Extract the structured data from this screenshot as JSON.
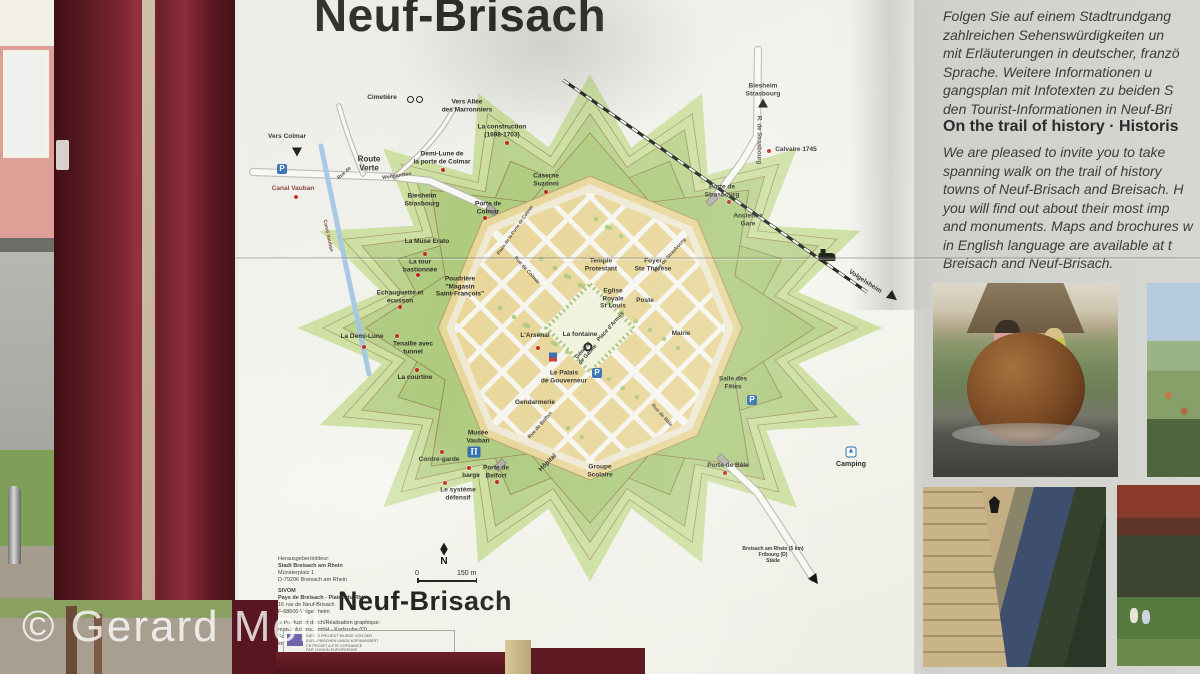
{
  "photo": {
    "watermark": "© Gerard Moll"
  },
  "sign": {
    "title": "Neuf-Brisach",
    "map": {
      "title": "Neuf-Brisach",
      "compass_glyph": "◆",
      "scale": {
        "zero": "0",
        "label": "150 m",
        "north": "N"
      },
      "glyphs": {
        "parking": "P",
        "museum": "Π",
        "camping": "▲"
      },
      "labels": [
        {
          "t": "Cimetière",
          "x": 137,
          "y": 58
        },
        {
          "t": "Vers Allée\ndes Marronniers",
          "x": 222,
          "y": 66
        },
        {
          "t": "Vers Colmar",
          "x": 42,
          "y": 97,
          "c": "b"
        },
        {
          "t": "Route\nVerte",
          "x": 124,
          "y": 124,
          "c": "b",
          "s": 8
        },
        {
          "t": "Rue de",
          "x": 100,
          "y": 134,
          "r": -42,
          "c": "street"
        },
        {
          "t": "Wolfgantzen",
          "x": 152,
          "y": 137,
          "r": -8,
          "c": "street"
        },
        {
          "t": "Demi-Lune de\nla porte de Colmar",
          "x": 197,
          "y": 118
        },
        {
          "t": "Canal Vauban",
          "x": 48,
          "y": 149,
          "c": "maroon"
        },
        {
          "t": "Canal Vauban",
          "x": 82,
          "y": 196,
          "r": 78,
          "c": "street maroon"
        },
        {
          "t": "Biesheim\nStrasbourg",
          "x": 177,
          "y": 160
        },
        {
          "t": "La construction\n(1698-1703)",
          "x": 257,
          "y": 91
        },
        {
          "t": "Caserne\nSuzonni",
          "x": 301,
          "y": 140
        },
        {
          "t": "Porte de\nColmar",
          "x": 243,
          "y": 168
        },
        {
          "t": "Place de la Porte de Colmar",
          "x": 270,
          "y": 190,
          "r": -55,
          "c": "street",
          "s": 4.5
        },
        {
          "t": "La Muse Erato",
          "x": 182,
          "y": 202
        },
        {
          "t": "La tour\nbastionnée",
          "x": 175,
          "y": 226
        },
        {
          "t": "Poudrière\n\"Magasin\nSaint-François\"",
          "x": 215,
          "y": 247
        },
        {
          "t": "Echauguette et\nécusson",
          "x": 155,
          "y": 257
        },
        {
          "t": "La Demi-Lune",
          "x": 117,
          "y": 297
        },
        {
          "t": "Tenaille avec\ntunnel",
          "x": 168,
          "y": 308
        },
        {
          "t": "La courtine",
          "x": 170,
          "y": 338
        },
        {
          "t": "L'Arsenal",
          "x": 290,
          "y": 296
        },
        {
          "t": "La fontaine",
          "x": 335,
          "y": 295
        },
        {
          "t": "Place d'Armes",
          "x": 366,
          "y": 287,
          "r": -48,
          "s": 5.5
        },
        {
          "t": "Général\nde Gaulle",
          "x": 341,
          "y": 313,
          "r": -48,
          "s": 5.5
        },
        {
          "t": "Temple\nProtestant",
          "x": 356,
          "y": 225
        },
        {
          "t": "Foyer\nSte Thérèse",
          "x": 408,
          "y": 225
        },
        {
          "t": "Eglise\nRoyale\nSt Louis",
          "x": 368,
          "y": 259
        },
        {
          "t": "Poste",
          "x": 400,
          "y": 261
        },
        {
          "t": "Mairie",
          "x": 436,
          "y": 294,
          "c": "b"
        },
        {
          "t": "Le Palais\nde Gouverneur",
          "x": 319,
          "y": 337
        },
        {
          "t": "Gendarmerie",
          "x": 290,
          "y": 363
        },
        {
          "t": "Musée\nVauban",
          "x": 233,
          "y": 397,
          "c": "b"
        },
        {
          "t": "Contre-garde",
          "x": 194,
          "y": 420
        },
        {
          "t": "barge",
          "x": 226,
          "y": 436
        },
        {
          "t": "Porte de\nBelfort",
          "x": 251,
          "y": 432
        },
        {
          "t": "Le système\ndéfensif",
          "x": 213,
          "y": 454
        },
        {
          "t": "Hôpital",
          "x": 303,
          "y": 423,
          "r": -45
        },
        {
          "t": "Groupe\nScolaire",
          "x": 355,
          "y": 431,
          "c": "b"
        },
        {
          "t": "Porte de Bâle",
          "x": 483,
          "y": 426
        },
        {
          "t": "Salle des\nFêtes",
          "x": 488,
          "y": 343
        },
        {
          "t": "Camping",
          "x": 606,
          "y": 425,
          "c": "b",
          "s": 7
        },
        {
          "t": "Porte de\nStrasbourg",
          "x": 477,
          "y": 151
        },
        {
          "t": "Calvaire 1745",
          "x": 551,
          "y": 110
        },
        {
          "t": "Ancienne\nGare",
          "x": 503,
          "y": 180
        },
        {
          "t": "Biesheim\nStrasbourg",
          "x": 518,
          "y": 50
        },
        {
          "t": "R. de Strasbourg",
          "x": 513,
          "y": 100,
          "r": 90,
          "c": "street",
          "s": 6
        },
        {
          "t": "Volgelsheim",
          "x": 620,
          "y": 242,
          "r": 33,
          "c": "b",
          "s": 6.5
        },
        {
          "t": "Rue de Colmar",
          "x": 281,
          "y": 231,
          "r": 48,
          "c": "street"
        },
        {
          "t": "Rue de Strasbourg",
          "x": 426,
          "y": 216,
          "r": -48,
          "c": "street"
        },
        {
          "t": "Rue de Belfort",
          "x": 296,
          "y": 386,
          "r": -48,
          "c": "street"
        },
        {
          "t": "Rue de Bâle",
          "x": 416,
          "y": 376,
          "r": 48,
          "c": "street"
        },
        {
          "t": "Breisach am Rhein (5 km)\nFribourg (D)\nStäde",
          "x": 528,
          "y": 516,
          "s": 5
        }
      ],
      "dots": [
        [
          262,
          103
        ],
        [
          301,
          152
        ],
        [
          198,
          130
        ],
        [
          240,
          178
        ],
        [
          180,
          214
        ],
        [
          173,
          235
        ],
        [
          155,
          267
        ],
        [
          119,
          307
        ],
        [
          152,
          296
        ],
        [
          172,
          330
        ],
        [
          197,
          412
        ],
        [
          224,
          428
        ],
        [
          200,
          443
        ],
        [
          252,
          442
        ],
        [
          480,
          433
        ],
        [
          484,
          162
        ],
        [
          524,
          111
        ],
        [
          293,
          308
        ],
        [
          51,
          157
        ]
      ],
      "icons": [
        {
          "type": "parking",
          "x": 37,
          "y": 129
        },
        {
          "type": "parking",
          "x": 352,
          "y": 333
        },
        {
          "type": "parking",
          "x": 507,
          "y": 360
        },
        {
          "type": "museum",
          "x": 229,
          "y": 412
        },
        {
          "type": "camping",
          "x": 606,
          "y": 412
        },
        {
          "type": "info",
          "x": 308,
          "y": 317
        },
        {
          "type": "fountain",
          "x": 343,
          "y": 307
        },
        {
          "type": "train",
          "x": 582,
          "y": 217
        },
        {
          "type": "bicycle",
          "x": 170,
          "y": 60
        },
        {
          "type": "arrow-up",
          "x": 518,
          "y": 63
        },
        {
          "type": "arrow-down",
          "x": 52,
          "y": 112
        },
        {
          "type": "arrow-se",
          "x": 648,
          "y": 257,
          "r": 38
        },
        {
          "type": "arrow-se",
          "x": 570,
          "y": 540,
          "r": 55
        },
        {
          "type": "gate",
          "x": 247,
          "y": 170,
          "r": 45
        },
        {
          "type": "gate",
          "x": 467,
          "y": 160,
          "r": -45
        },
        {
          "type": "gate",
          "x": 478,
          "y": 420,
          "r": 45
        },
        {
          "type": "gate",
          "x": 255,
          "y": 425,
          "r": -45
        }
      ]
    },
    "credits": {
      "lines": [
        {
          "t": "Herausgeber/éditeur:"
        },
        {
          "t": "Stadt Breisach am Rhein",
          "b": 1
        },
        {
          "t": "Münsterplatz 1"
        },
        {
          "t": "D-79206 Breisach am Rhein"
        },
        {
          "t": "SIVOM",
          "b": 1,
          "gap": 1
        },
        {
          "t": "Pays de Breisach - Plaine du Rhin",
          "b": 1
        },
        {
          "t": "16 rue de Neuf-Brisach"
        },
        {
          "t": "F-68600 Volgelsheim"
        },
        {
          "t": "© Produziert durch/Réalisation graphique:",
          "gap": 1
        },
        {
          "t": "map.solutions GmbH · Karlsruhe (D)"
        },
        {
          "t": "Fon 0721/9199006 · Fax 0721/9199007"
        },
        {
          "t": "info@mapsolutions.de"
        },
        {
          "t": "Fotos/Crédit photos: Stadt Breisach/Studio A Neuf-Brisach",
          "gap": 1
        }
      ]
    },
    "eu_box": {
      "lines": [
        "DIESES PROJEKT WURDE VON DER",
        "EUROPÄISCHEN UNION KOFINANZIERT",
        "CE PROJET A ETE COFINANCE",
        "PAR L'UNION EUROPEENNE"
      ]
    },
    "right_panel": {
      "german_lines": [
        "Folgen Sie auf einem Stadtrundgang",
        "zahlreichen Sehenswürdigkeiten un",
        "mit Erläuterungen in deutscher, franzö",
        "Sprache. Weitere Informationen u",
        "gangsplan mit Infotexten zu beiden S",
        "den Tourist-Informationen in Neuf-Bri"
      ],
      "english_heading": "On the trail of history · Historis",
      "english_lines": [
        "We are pleased to invite you to take",
        "spanning walk on the trail of history",
        "towns of Neuf-Brisach and Breisach. H",
        "you will find out about their most imp",
        "and monuments. Maps and brochures w",
        "in English language are available at t",
        "Breisach and Neuf-Brisach."
      ]
    }
  }
}
